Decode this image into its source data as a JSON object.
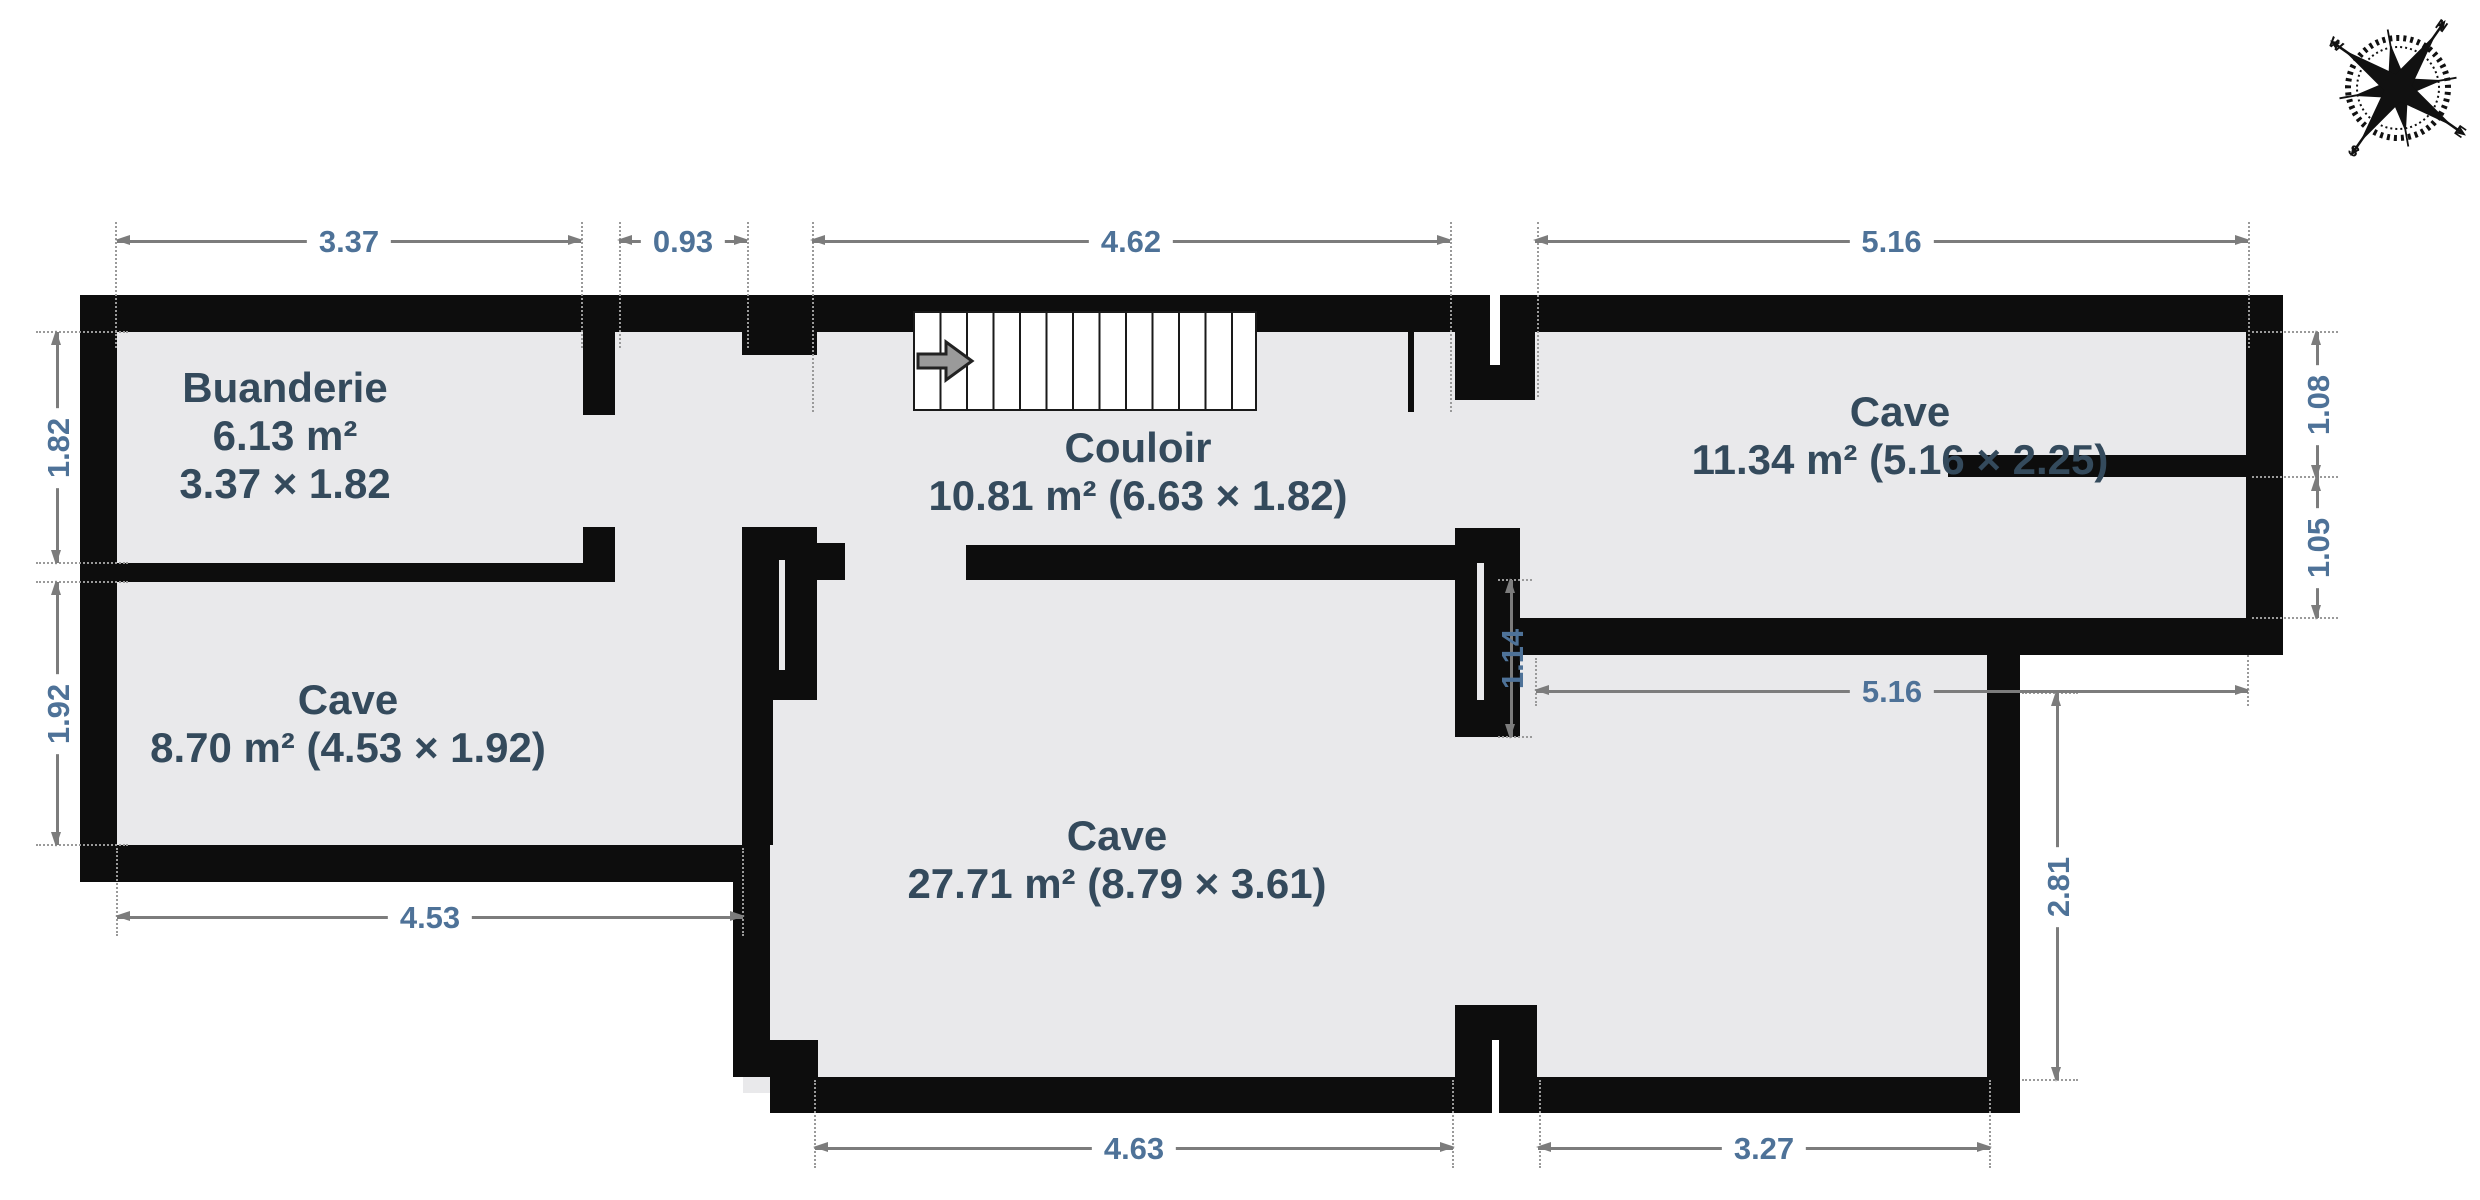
{
  "plan": {
    "type": "basement-floor-plan",
    "language": "fr"
  },
  "rooms": {
    "buanderie": {
      "name": "Buanderie",
      "area": "6.13 m²",
      "size": "3.37 × 1.82"
    },
    "cave_left": {
      "name": "Cave",
      "details": "8.70 m² (4.53 × 1.92)"
    },
    "couloir": {
      "name": "Couloir",
      "details": "10.81 m² (6.63 × 1.82)"
    },
    "cave_right": {
      "name": "Cave",
      "details": "11.34 m² (5.16 × 2.25)"
    },
    "cave_main": {
      "name": "Cave",
      "details": "27.71 m² (8.79 × 3.61)"
    }
  },
  "dimensions": {
    "top": [
      "3.37",
      "0.93",
      "4.62",
      "5.16"
    ],
    "left": [
      "1.82",
      "1.92"
    ],
    "right": [
      "1.08",
      "1.05"
    ],
    "bottom_left": [
      "4.53"
    ],
    "bottom": [
      "4.63",
      "3.27"
    ],
    "interior": [
      "5.16",
      "2.81",
      "1.14"
    ]
  },
  "compass": {
    "north": "N",
    "east": "E",
    "south": "S",
    "west": "W"
  },
  "colors": {
    "floor": "#e9e9eb",
    "wall": "#0d0d0d",
    "dim_line": "#7c7c7c",
    "dim_text": "#4e7298",
    "room_text": "#344a5c"
  }
}
